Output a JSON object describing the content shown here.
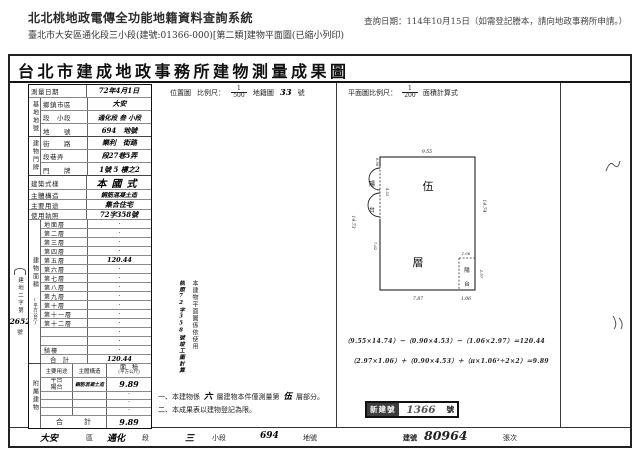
{
  "header": {
    "system_title": "北北桃地政電傳全功能地籍資料查詢系統",
    "query_date": "查詢日期：114年10月15日（如需登記謄本，請向地政事務所申請。）",
    "doc_info": "臺北市大安區通化段三小段(建號:01366-000)[第二類]建物平面圖(已縮小列印)"
  },
  "document": {
    "title": "台北市建成地政事務所建物測量成果圖",
    "form": {
      "survey_label": "測量日期",
      "survey_value": "72年4月1日",
      "site_group": "基地地號",
      "site_rows": [
        {
          "label": "鄉鎮市區",
          "value": "大安"
        },
        {
          "label": "段　小段",
          "value": "通化段 叁 小段"
        },
        {
          "label": "地　　號",
          "value": "694　地號"
        }
      ],
      "door_group": "建物門牌",
      "door_rows": [
        {
          "label": "街　　路",
          "value": "樂利　街路"
        },
        {
          "label": "段巷弄",
          "value": "段27巷5弄"
        },
        {
          "label": "門　　牌",
          "value": "1號 5 樓之2"
        }
      ],
      "style_label": "建築式樣",
      "style_value": "本國式",
      "structure_label": "主體構造",
      "structure_value": "鋼筋混凝土造",
      "use_label": "主要用途",
      "use_value": "集合住宅",
      "license_label": "使用執照",
      "license_value": "72字358號",
      "area_group": "建物面積",
      "area_group_unit": "(平方公尺)",
      "floor_rows": [
        {
          "label": "地面層",
          "value": "·"
        },
        {
          "label": "第二層",
          "value": "·"
        },
        {
          "label": "第三層",
          "value": "·"
        },
        {
          "label": "第四層",
          "value": "·"
        },
        {
          "label": "第五層",
          "value": "120.44",
          "hw": true
        },
        {
          "label": "第六層",
          "value": "·"
        },
        {
          "label": "第七層",
          "value": "·"
        },
        {
          "label": "第八層",
          "value": "·"
        },
        {
          "label": "第九層",
          "value": "·"
        },
        {
          "label": "第十層",
          "value": "·"
        },
        {
          "label": "第十一層",
          "value": "·"
        },
        {
          "label": "第十二層",
          "value": "·"
        },
        {
          "label": "",
          "value": "·"
        },
        {
          "label": "",
          "value": "·"
        },
        {
          "label": "騎樓",
          "value": "·"
        },
        {
          "label": "合計",
          "value": "120.44",
          "hw": true,
          "cls": "total"
        }
      ],
      "annex_group": "附屬建物",
      "annex_headers": {
        "use": "主要用途",
        "structure": "主體構造",
        "area": "面　積",
        "area_unit": "(平方公尺)"
      },
      "annex_row": {
        "use_line1": "平台",
        "use_line2": "陽台",
        "structure": "鋼筋混凝土造",
        "area": "9.89"
      },
      "annex_blank_rows": [
        {
          "value": "·"
        },
        {
          "value": "·"
        },
        {
          "value": "·"
        }
      ],
      "annex_total_label": "合　計",
      "annex_total_value": "9.89"
    },
    "margin_note": {
      "text": "建地二字第",
      "number": "2652",
      "suffix": "號"
    },
    "location_map": {
      "label": "位置圖",
      "scale_label": "比例尺：",
      "numerator": "1",
      "denominator": "500",
      "map_label": "地籍圖",
      "sheet_no": "33",
      "sheet_suffix": "號"
    },
    "plan_header": {
      "scale_label": "平面圖比例尺：",
      "numerator": "1",
      "denominator": "200",
      "calc_label": "面積計算式"
    },
    "plan": {
      "room_label_top": "伍",
      "room_label_bottom": "層",
      "balcony_left_1": "陽",
      "balcony_left_2": "台",
      "balcony_corner_1": "陽",
      "balcony_corner_2": "台",
      "dim_top": "9.55",
      "dim_left": "14.73",
      "dim_right": "14.74",
      "dim_bottom_main": "7.87",
      "dim_bottom_corner": "1.06",
      "dim_bump_depth": "0.90",
      "dim_bump_span": "4.53",
      "dim_wall_lower": "7.62",
      "dim_corner_top": "1.06",
      "dim_corner_right": "2.97"
    },
    "formulas": [
      "（9.55×14.74）－（0.90×4.53）－（1.06×2.97）＝120.44",
      "（2.97×1.06）＋（0.90×4.53）＋（π×1.06²÷2×2）＝9.89"
    ],
    "vertical_note": {
      "col1": "本建物平面圖係依使用",
      "col2": "執照72字358號竣工圖計算"
    },
    "note1": {
      "prefix": "一、本建物係",
      "hand1": "六",
      "mid": "層建物本件僅測量第",
      "hand2": "伍",
      "suffix": "層部分。"
    },
    "note2": "二、本成果表以建物登記為限。",
    "stamp": {
      "label": "新建號",
      "number": "1366",
      "suffix": "號"
    },
    "footer": {
      "district": "大安",
      "district_suffix": "區",
      "section": "通化",
      "section_suffix": "段",
      "subsection": "三",
      "subsection_suffix": "小段",
      "parcel": "694",
      "parcel_suffix": "地號",
      "building_label": "建號",
      "building_no": "80964",
      "sheet_label": "張次"
    }
  }
}
